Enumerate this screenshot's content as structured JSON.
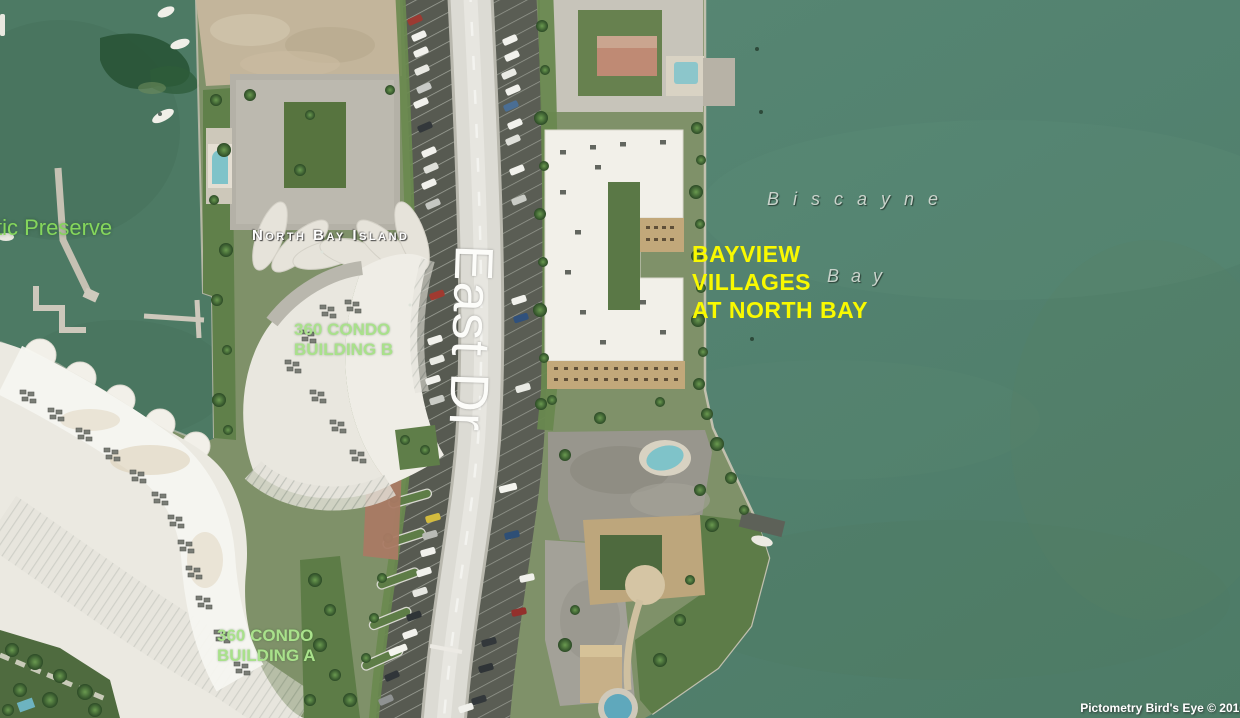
{
  "map": {
    "labels": {
      "preserve": "tic Preserve",
      "island": "North Bay Island",
      "road": "East Dr",
      "water_word1": "Biscayne",
      "water_word2": "Bay",
      "bayview_line1": "BAYVIEW",
      "bayview_line2": "VILLAGES",
      "bayview_line3": "AT NORTH BAY",
      "condo_b_line1": "360 CONDO",
      "condo_b_line2": "BUILDING B",
      "condo_a_line1": "360 CONDO",
      "condo_a_line2": "BUILDING A"
    },
    "attribution": "Pictometry Bird's Eye © 2016",
    "colors": {
      "water": "#54836e",
      "water_dark": "#4d7a64",
      "label_yellow": "#f9f900",
      "label_green": "#a9e18b",
      "label_preserve": "#85d65c",
      "label_white": "#ffffff",
      "label_gray": "#c9d3cb",
      "roof_white": "#f2f0e9",
      "facade_tan": "#c2a87a",
      "road": "#dcdbd4"
    }
  }
}
